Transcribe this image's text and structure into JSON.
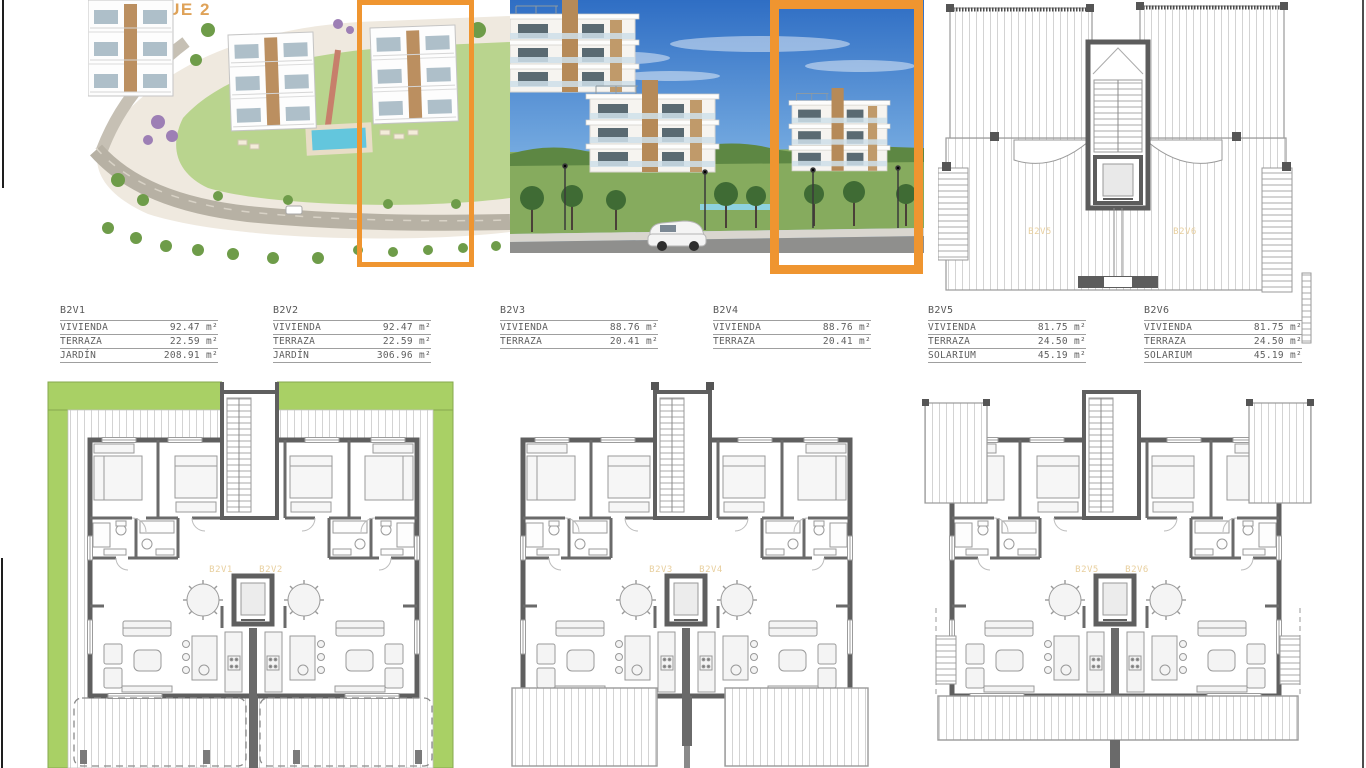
{
  "title": "BLOQUE 2",
  "colors": {
    "accent_orange": "#EF9530",
    "title_orange": "#DFA258",
    "plan_label_orange": "#E8CF9E",
    "garden_green": "#A9D065",
    "wall_gray": "#5F5F5F"
  },
  "tables": [
    {
      "unit": "B2V1",
      "rows": [
        [
          "VIVIENDA",
          "92.47 m²"
        ],
        [
          "TERRAZA",
          "22.59 m²"
        ],
        [
          "JARDÍN",
          "208.91 m²"
        ]
      ]
    },
    {
      "unit": "B2V2",
      "rows": [
        [
          "VIVIENDA",
          "92.47 m²"
        ],
        [
          "TERRAZA",
          "22.59 m²"
        ],
        [
          "JARDÍN",
          "306.96 m²"
        ]
      ]
    },
    {
      "unit": "B2V3",
      "rows": [
        [
          "VIVIENDA",
          "88.76 m²"
        ],
        [
          "TERRAZA",
          "20.41 m²"
        ]
      ]
    },
    {
      "unit": "B2V4",
      "rows": [
        [
          "VIVIENDA",
          "88.76 m²"
        ],
        [
          "TERRAZA",
          "20.41 m²"
        ]
      ]
    },
    {
      "unit": "B2V5",
      "rows": [
        [
          "VIVIENDA",
          "81.75 m²"
        ],
        [
          "TERRAZA",
          "24.50 m²"
        ],
        [
          "SOLARIUM",
          "45.19 m²"
        ]
      ]
    },
    {
      "unit": "B2V6",
      "rows": [
        [
          "VIVIENDA",
          "81.75 m²"
        ],
        [
          "TERRAZA",
          "24.50 m²"
        ],
        [
          "SOLARIUM",
          "45.19 m²"
        ]
      ]
    }
  ],
  "plan_labels": {
    "roof": [
      "B2V5",
      "B2V6"
    ],
    "ground": [
      "B2V1",
      "B2V2"
    ],
    "first": [
      "B2V3",
      "B2V4"
    ],
    "second": [
      "B2V5",
      "B2V6"
    ]
  }
}
